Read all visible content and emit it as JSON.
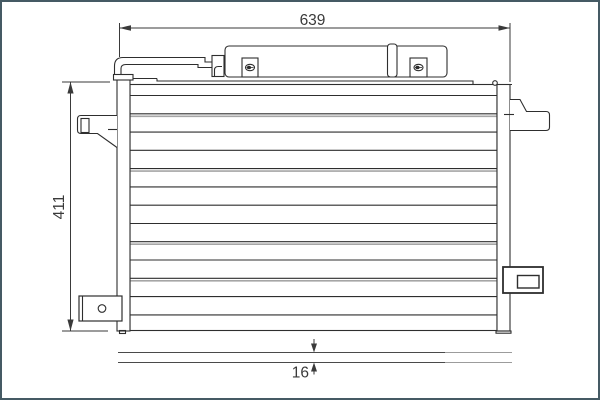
{
  "drawing": {
    "dim_width_label": "639",
    "dim_height_label": "411",
    "dim_depth_label": "16"
  },
  "icons": {
    "screw_left": "screw-icon",
    "screw_right": "screw-icon"
  },
  "colors": {
    "frame_border": "#455a64",
    "line": "#2e2e2e",
    "secondary_line": "#a6a6a6",
    "background": "#ffffff"
  }
}
